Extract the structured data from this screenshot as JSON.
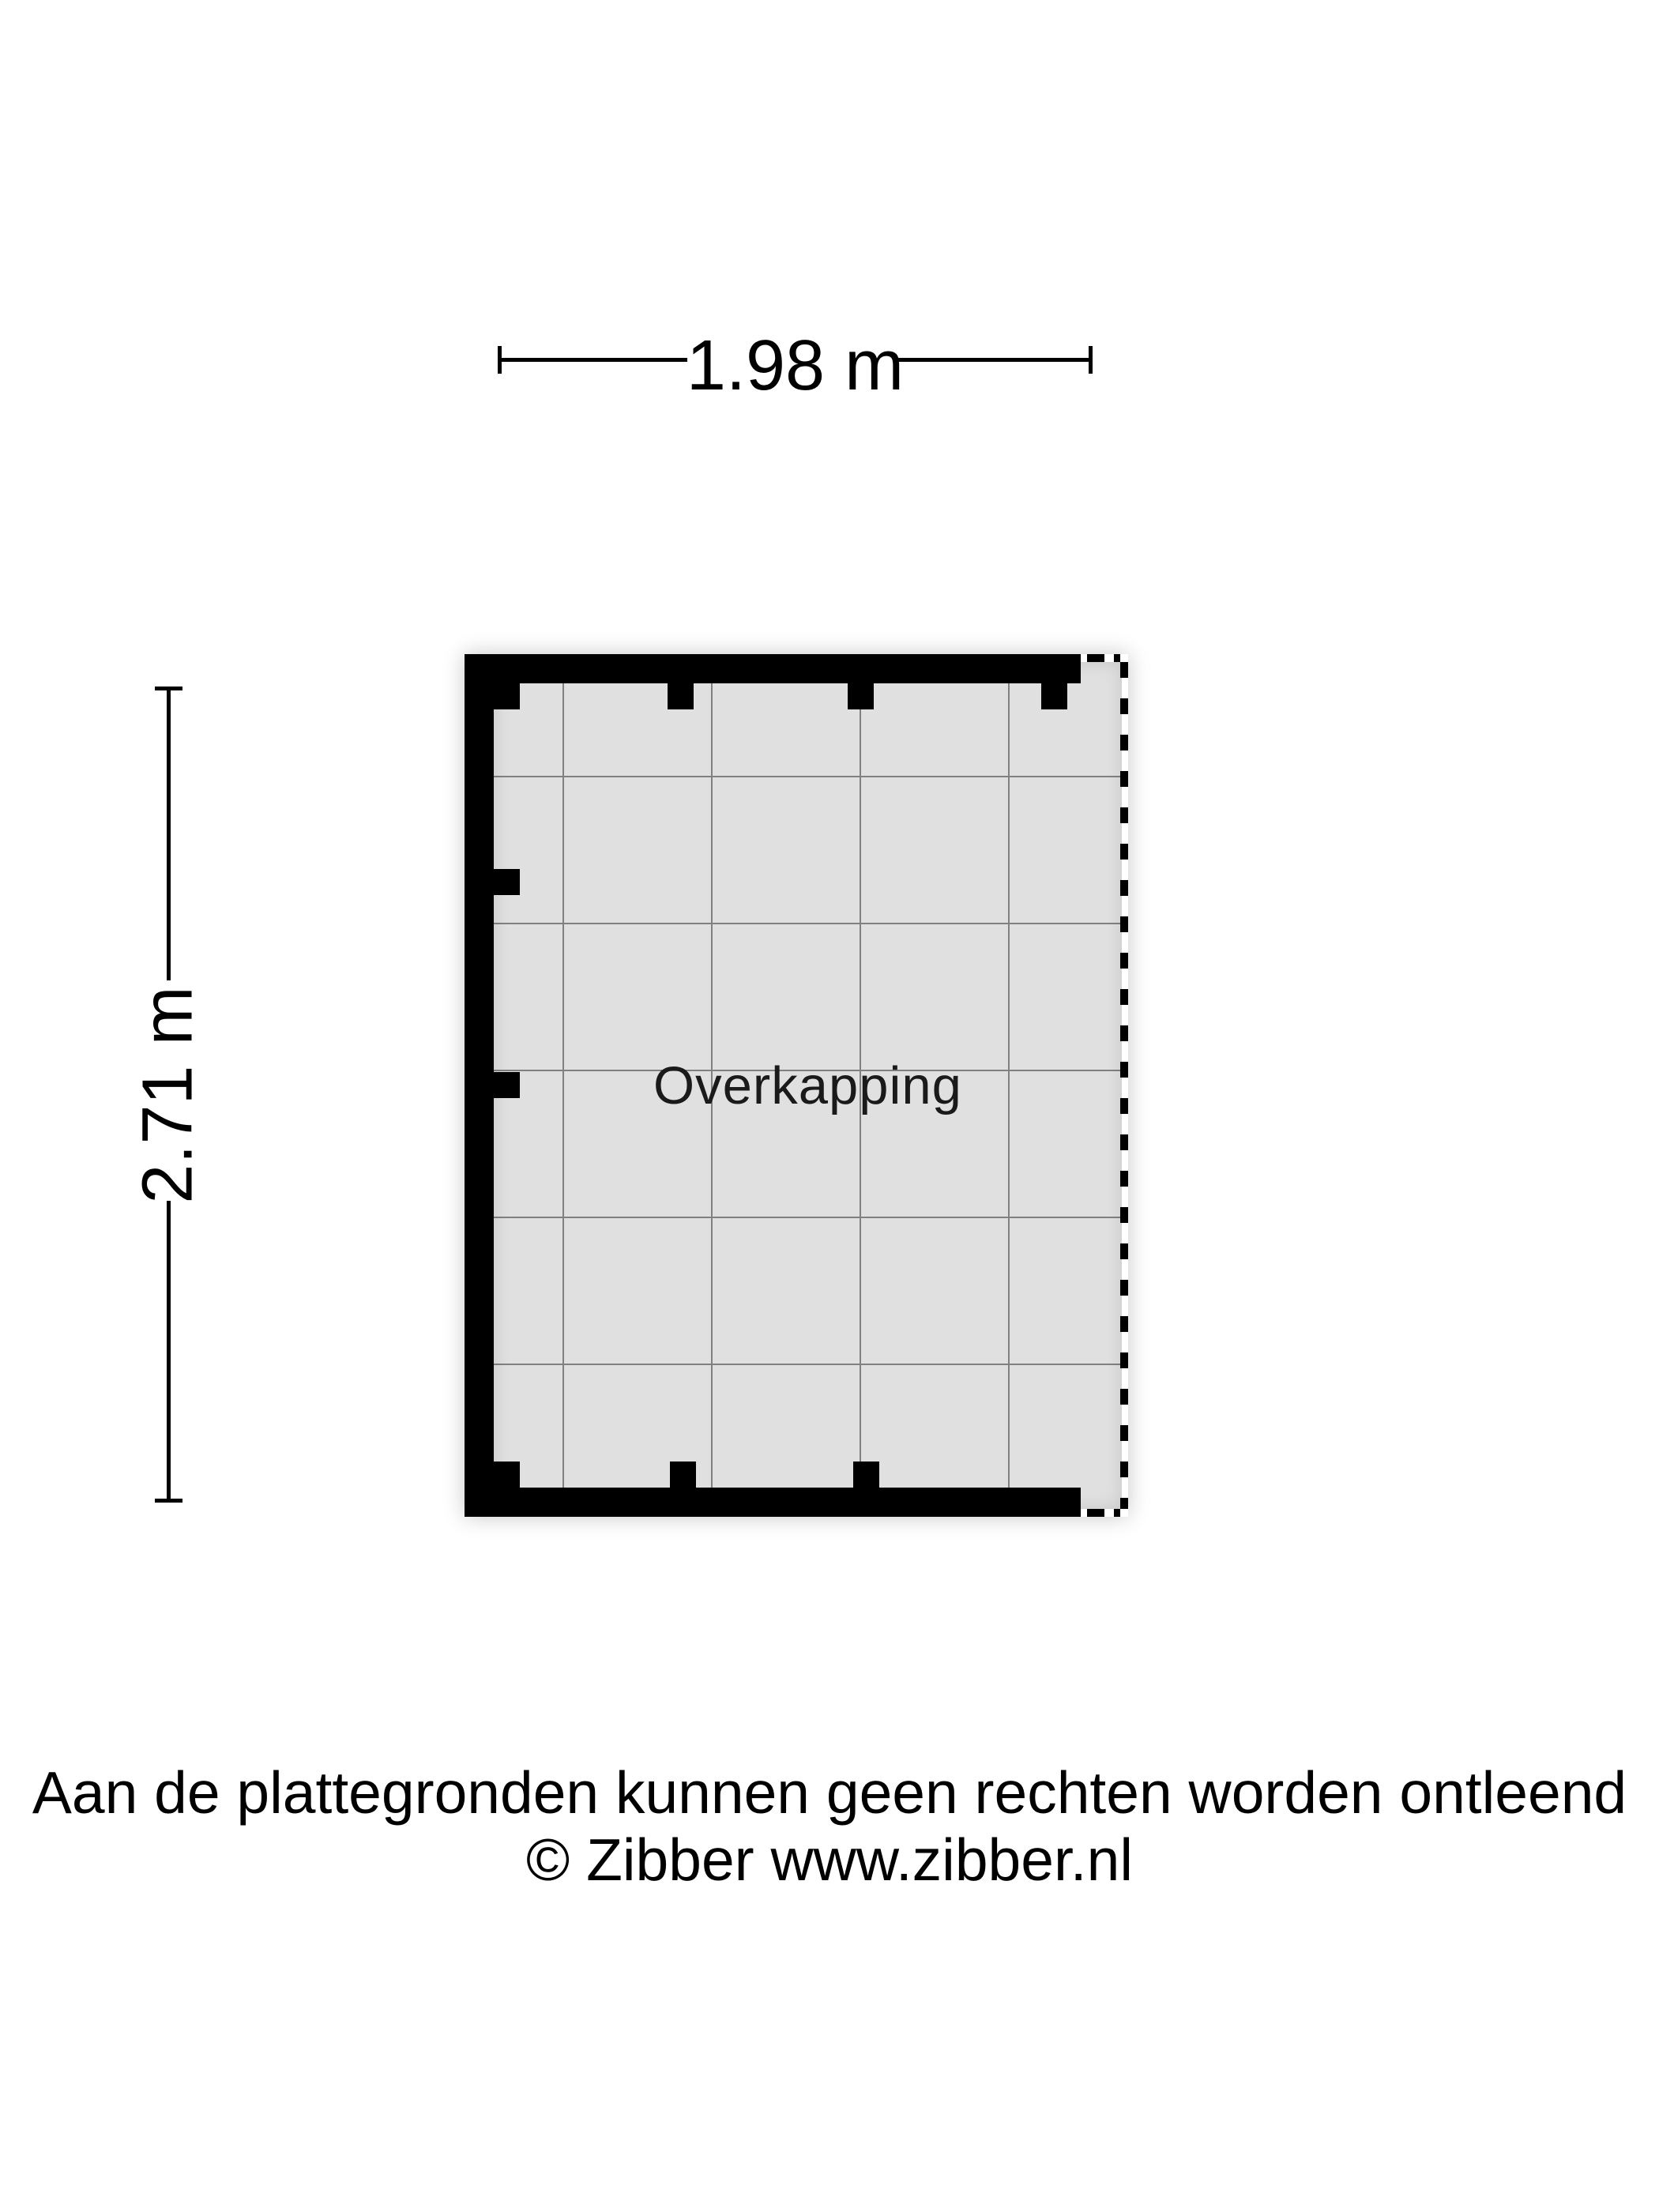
{
  "dimensions": {
    "width_label": "1.98 m",
    "height_label": "2.71 m"
  },
  "room": {
    "label": "Overkapping"
  },
  "footer": {
    "disclaimer": "Aan de plattegronden kunnen geen rechten worden ontleend",
    "copyright": "© Zibber www.zibber.nl"
  },
  "colors": {
    "wall": "#000000",
    "floor": "#e0e0e0",
    "grid_line": "#808080",
    "ink": "#000000",
    "text": "#1a1a1a",
    "background": "#ffffff"
  }
}
